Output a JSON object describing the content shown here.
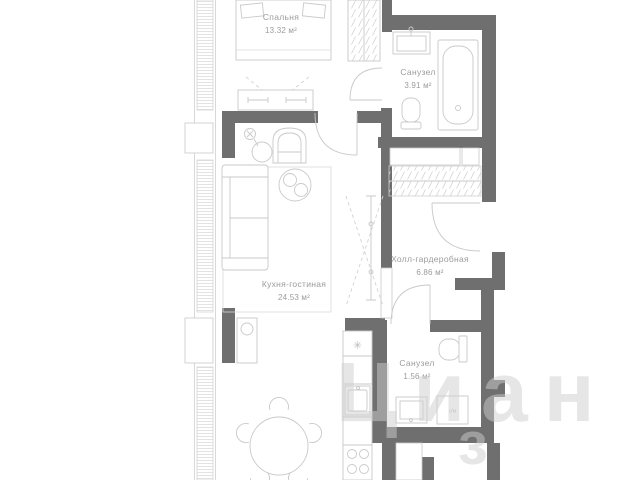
{
  "plan": {
    "rooms": [
      {
        "name": "Спальня",
        "area": "13.32 м²"
      },
      {
        "name": "Санузел",
        "area": "3.91 м²"
      },
      {
        "name": "Холл-гардеробная",
        "area": "6.86 м²"
      },
      {
        "name": "Кухня-гостиная",
        "area": "24.53 м²"
      },
      {
        "name": "Санузел",
        "area": "1.56 м²"
      }
    ],
    "appliances": {
      "washer_label": "с/м",
      "fridge_symbol": "✳"
    },
    "watermark": {
      "line1": "Циан",
      "line2": "з"
    },
    "colors": {
      "wall": "#6f6f6f",
      "furniture_line": "#c9c9c9",
      "label_text": "#9b9b9b",
      "background": "#ffffff",
      "watermark": "rgba(206,206,206,0.5)"
    }
  }
}
